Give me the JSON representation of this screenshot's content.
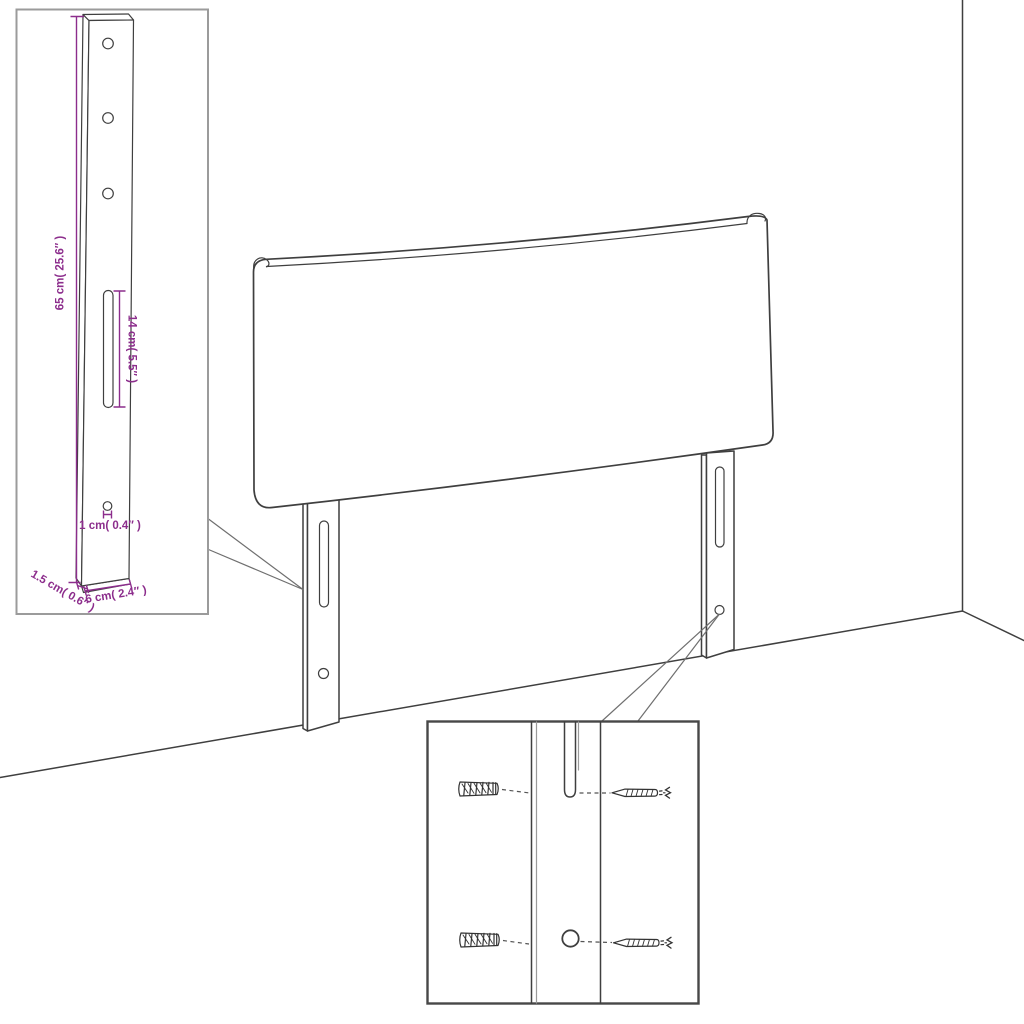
{
  "colors": {
    "background": "#FFFFFF",
    "line": "#3F3F3F",
    "annotation": "#8C2D8C",
    "inset_border_light": "#9B9B9B",
    "inset_border_dark": "#474747"
  },
  "labels": {
    "bracket_height": "65 cm( 25.6″ )",
    "slot_length": "14 cm( 5.5″ )",
    "hole_size": "1 cm( 0.4″ )",
    "side_thickness": "1.5 cm( 0.6″ )",
    "bracket_width": "6 cm( 2.4″ )"
  }
}
